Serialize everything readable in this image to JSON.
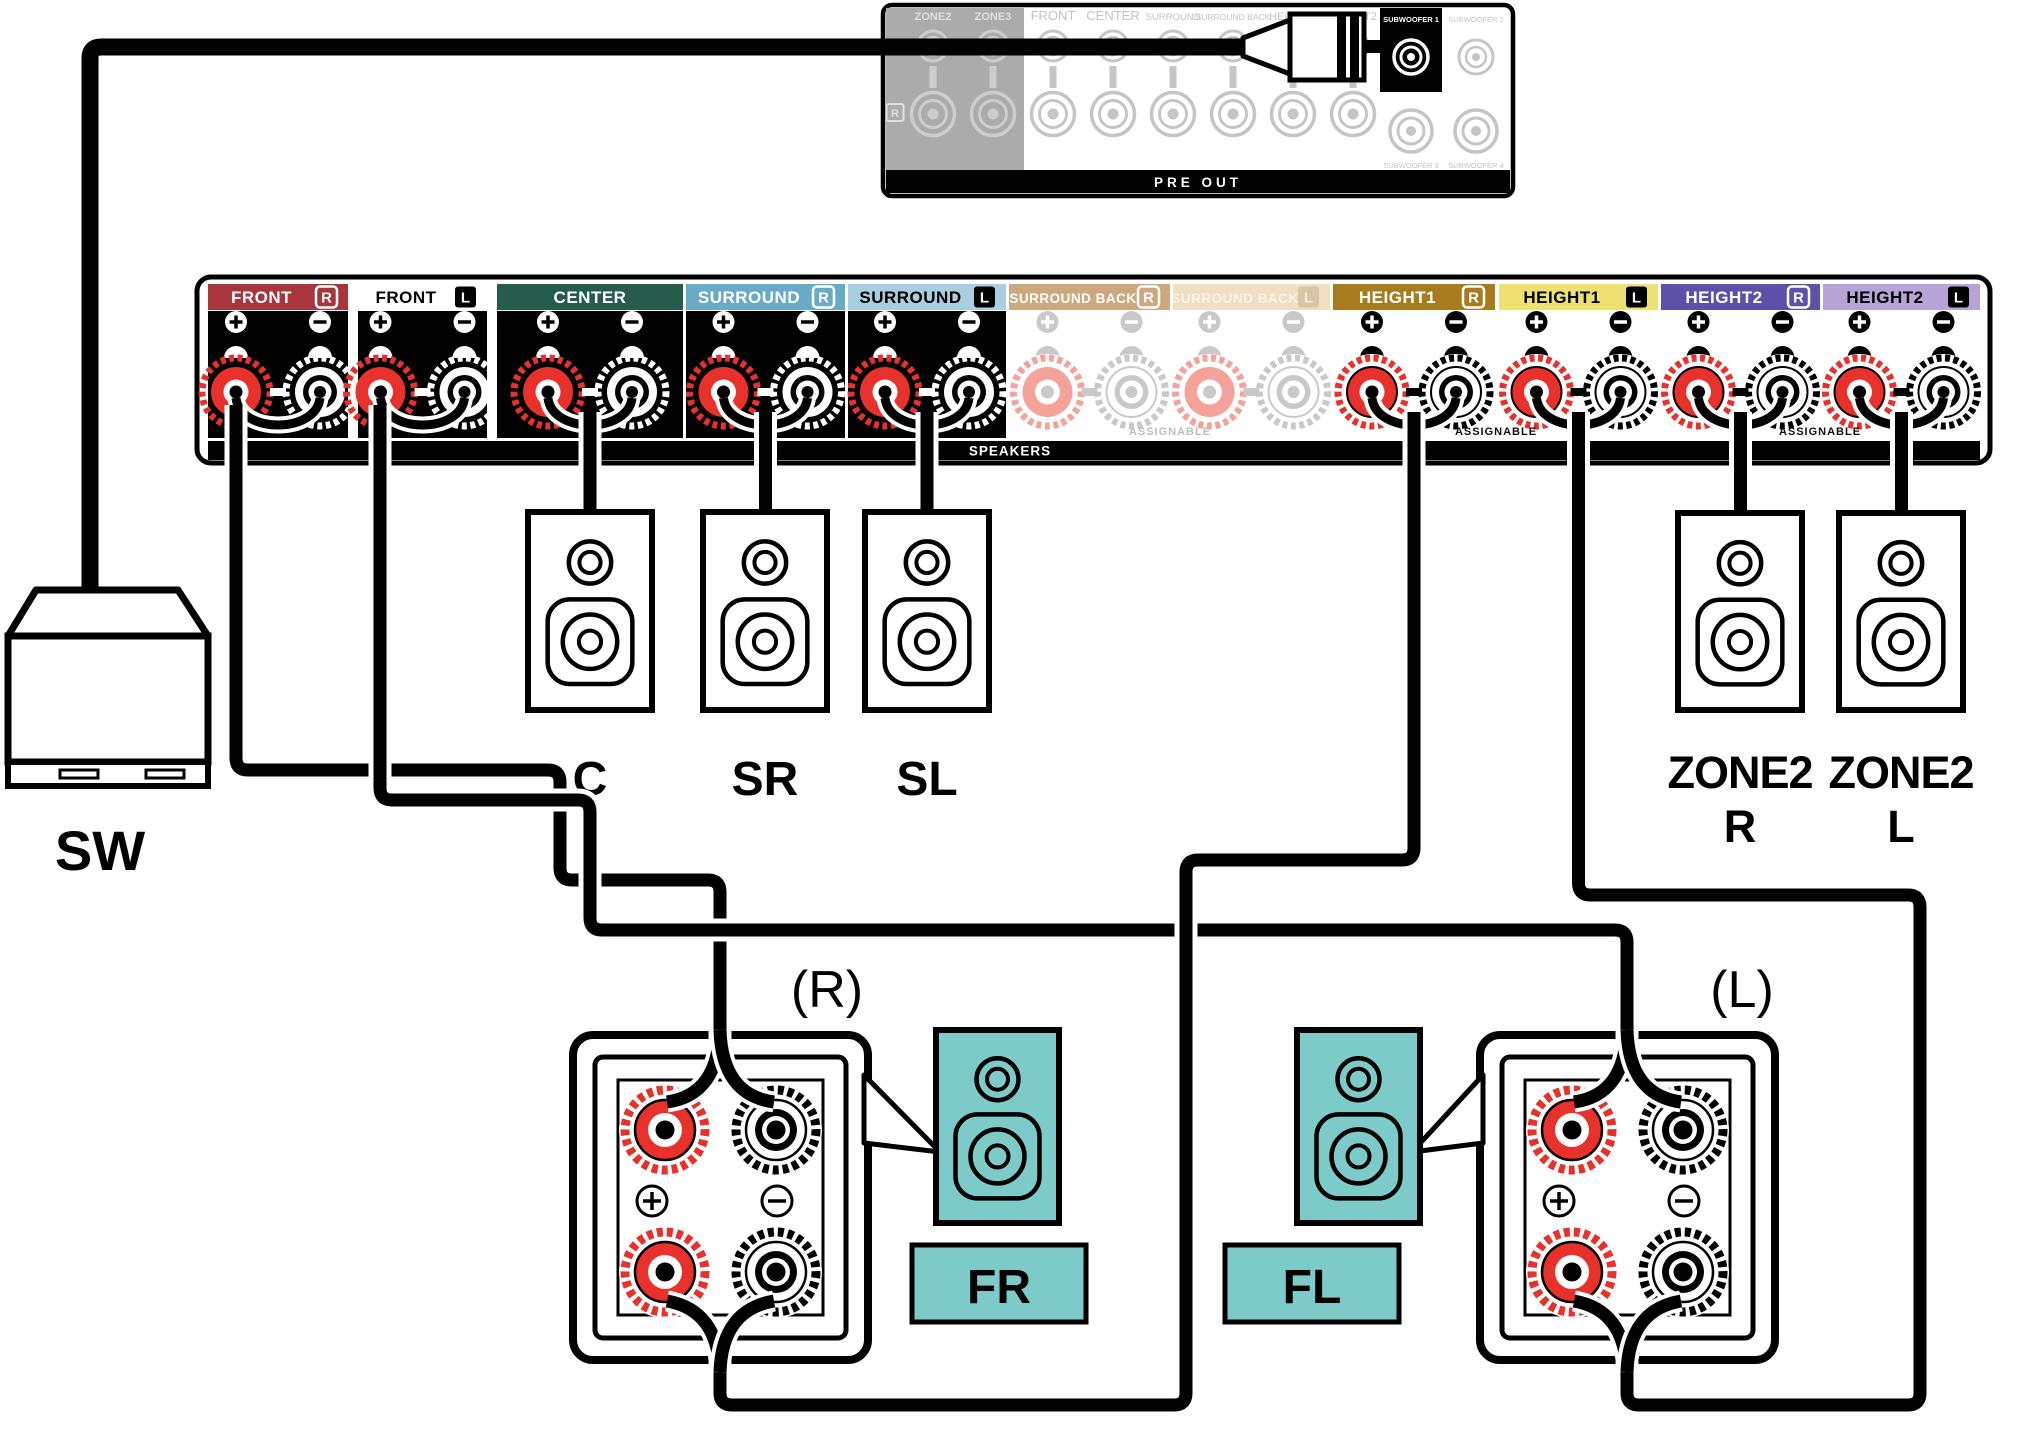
{
  "pre_out": {
    "panel_label": "PRE OUT",
    "right_channel_label": "R",
    "jack_labels": [
      "ZONE2",
      "ZONE3",
      "FRONT",
      "CENTER",
      "SURROUND",
      "SURROUND BACK",
      "HEIGHT1",
      "HEIGHT2"
    ],
    "subwoofer_labels": [
      "SUBWOOFER 1",
      "SUBWOOFER 2",
      "SUBWOOFER 3",
      "SUBWOOFER 4"
    ]
  },
  "speaker_terminals": {
    "panel_label": "SPEAKERS",
    "assignable_label": "ASSIGNABLE",
    "sections": [
      {
        "label": "FRONT",
        "channel": "R",
        "bar_color": "#A8343C",
        "text_color": "#FFFFFF",
        "badge": "outline",
        "posts": "black",
        "connected": true
      },
      {
        "label": "FRONT",
        "channel": "L",
        "bar_color": "#FFFFFF",
        "text_color": "#000000",
        "badge": "solid",
        "posts": "black",
        "connected": true
      },
      {
        "label": "CENTER",
        "channel": "",
        "bar_color": "#265C4B",
        "text_color": "#FFFFFF",
        "badge": "none",
        "posts": "black",
        "connected": true
      },
      {
        "label": "SURROUND",
        "channel": "R",
        "bar_color": "#69AAC9",
        "text_color": "#FFFFFF",
        "badge": "outline",
        "posts": "black",
        "connected": true
      },
      {
        "label": "SURROUND",
        "channel": "L",
        "bar_color": "#A9CEDF",
        "text_color": "#000000",
        "badge": "solid",
        "posts": "black",
        "connected": true
      },
      {
        "label": "SURROUND BACK",
        "channel": "R",
        "bar_color": "#CBA87E",
        "text_color": "#FFFFFF",
        "badge": "outline",
        "posts": "pale",
        "connected": false
      },
      {
        "label": "SURROUND BACK",
        "channel": "L",
        "bar_color": "#F1DFC4",
        "text_color": "#FBF3E2",
        "badge": "pale",
        "posts": "pale",
        "connected": false
      },
      {
        "label": "HEIGHT1",
        "channel": "R",
        "bar_color": "#A67C1E",
        "text_color": "#FFFFFF",
        "badge": "outline",
        "posts": "white",
        "connected": true
      },
      {
        "label": "HEIGHT1",
        "channel": "L",
        "bar_color": "#EDE271",
        "text_color": "#000000",
        "badge": "solid",
        "posts": "white",
        "connected": true
      },
      {
        "label": "HEIGHT2",
        "channel": "R",
        "bar_color": "#5C50A8",
        "text_color": "#FFFFFF",
        "badge": "outline",
        "posts": "white",
        "connected": true
      },
      {
        "label": "HEIGHT2",
        "channel": "L",
        "bar_color": "#B7A4D6",
        "text_color": "#000000",
        "badge": "solid",
        "posts": "white",
        "connected": true
      }
    ]
  },
  "speakers": {
    "subwoofer": "SW",
    "center": "C",
    "surround_right": "SR",
    "surround_left": "SL",
    "zone2_right": {
      "line1": "ZONE2",
      "line2": "R"
    },
    "zone2_left": {
      "line1": "ZONE2",
      "line2": "L"
    },
    "front_right_terminal": "(R)",
    "front_left_terminal": "(L)",
    "front_right": "FR",
    "front_left": "FL"
  },
  "colors": {
    "post_red": "#E8312B",
    "pale_red": "#F4A29A",
    "pale_gray": "#C9C9C9",
    "speaker_teal": "#7DCBC8",
    "panel_gray": "#ABABAB",
    "inactive_gray": "#C3C3C3"
  }
}
